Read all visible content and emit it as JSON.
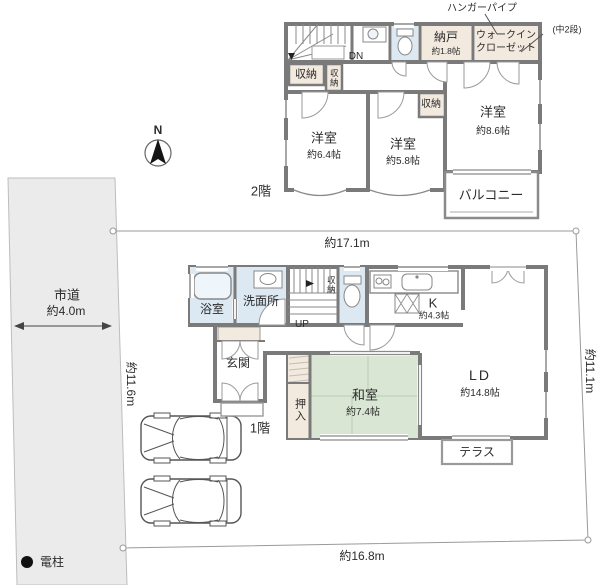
{
  "site": {
    "north_label": "N",
    "pole_label": "電柱",
    "road": {
      "name": "市道",
      "width": "約4.0m"
    },
    "dimensions": {
      "top": "約17.1m",
      "right": "約11.1m",
      "left": "約11.6m",
      "bottom": "約16.8m"
    }
  },
  "floor2": {
    "label": "2階",
    "stair_label": "DN",
    "notes": {
      "hanger_pipe": "ハンガーパイプ",
      "mid_shelf": "(中2段)"
    },
    "rooms": {
      "bedroom_w": {
        "name": "洋室",
        "size": "約6.4帖"
      },
      "bedroom_c": {
        "name": "洋室",
        "size": "約5.8帖"
      },
      "bedroom_e": {
        "name": "洋室",
        "size": "約8.6帖"
      },
      "nando": {
        "name": "納戸",
        "size": "約1.8帖"
      },
      "wic": {
        "line1": "ウォークイン",
        "line2": "クローゼット"
      },
      "closet_a": "収納",
      "closet_b": "収納",
      "closet_c": "収納",
      "balcony": "バルコニー"
    }
  },
  "floor1": {
    "label": "1階",
    "stair_label": "UP",
    "rooms": {
      "bath": "浴室",
      "washroom": "洗面所",
      "closet": "収納",
      "kitchen": {
        "name": "K",
        "size": "約4.3帖"
      },
      "living_dining": {
        "name": "LD",
        "size": "約14.8帖"
      },
      "washitsu": {
        "name": "和室",
        "size": "約7.4帖"
      },
      "oshiire": "押入",
      "entrance": "玄関",
      "terrace": "テラス"
    }
  },
  "colors": {
    "wall": "#7a7a7a",
    "water_room": "#dce9f3",
    "storage_room": "#f2e9df",
    "tatami": "#d9e6d4",
    "road": "#ebebeb"
  }
}
